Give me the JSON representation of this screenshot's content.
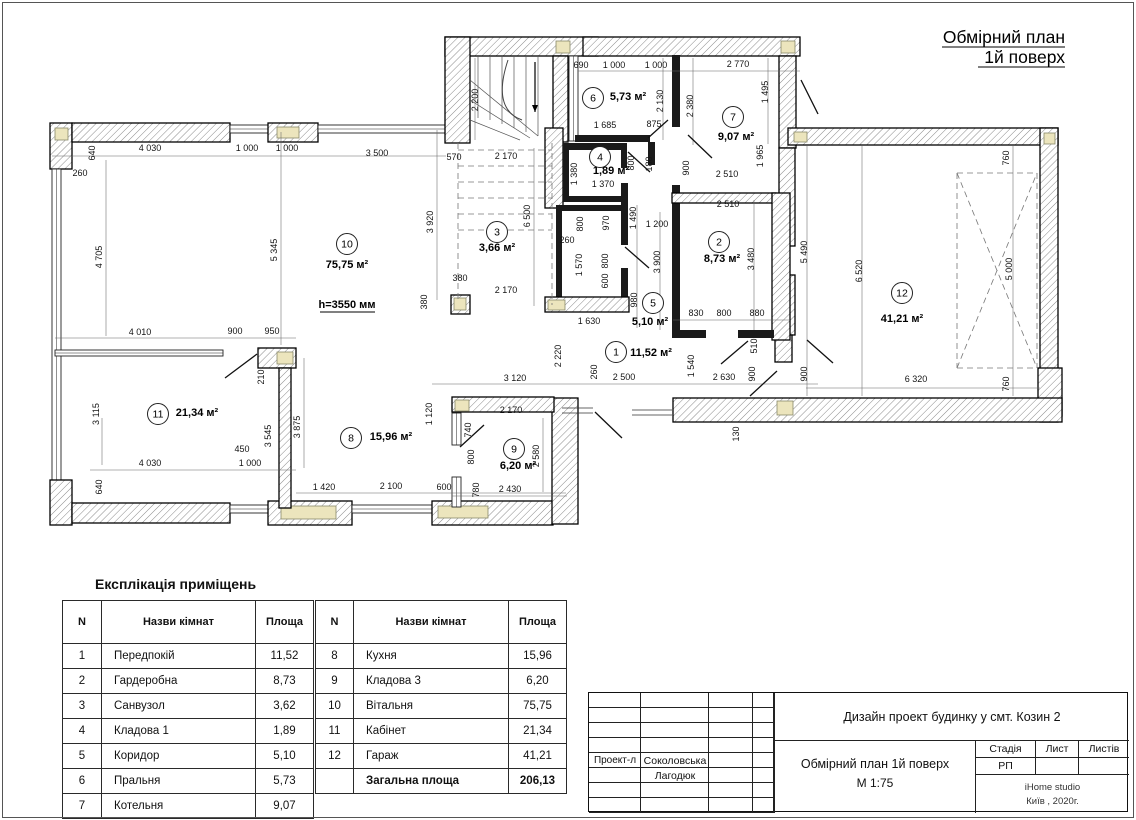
{
  "page_title": {
    "line1": "Обмірний план",
    "line2": "1й поверх"
  },
  "plan": {
    "height_note": "h=3550 мм",
    "rooms": [
      {
        "n": "1",
        "area": "11,52 м²",
        "cx": 616,
        "cy": 352,
        "ax": 651,
        "ay": 356
      },
      {
        "n": "2",
        "area": "8,73 м²",
        "cx": 719,
        "cy": 242,
        "ax": 722,
        "ay": 262
      },
      {
        "n": "3",
        "area": "3,66 м²",
        "cx": 497,
        "cy": 232,
        "ax": 497,
        "ay": 251
      },
      {
        "n": "4",
        "area": "1,89 м²",
        "cx": 600,
        "cy": 157,
        "ax": 611,
        "ay": 174
      },
      {
        "n": "5",
        "area": "5,10 м²",
        "cx": 653,
        "cy": 303,
        "ax": 650,
        "ay": 325
      },
      {
        "n": "6",
        "area": "5,73 м²",
        "cx": 593,
        "cy": 98,
        "ax": 628,
        "ay": 100
      },
      {
        "n": "7",
        "area": "9,07 м²",
        "cx": 733,
        "cy": 117,
        "ax": 736,
        "ay": 140
      },
      {
        "n": "8",
        "area": "15,96 м²",
        "cx": 351,
        "cy": 438,
        "ax": 391,
        "ay": 440
      },
      {
        "n": "9",
        "area": "6,20 м²",
        "cx": 514,
        "cy": 449,
        "ax": 518,
        "ay": 469
      },
      {
        "n": "10",
        "area": "75,75 м²",
        "cx": 347,
        "cy": 244,
        "ax": 347,
        "ay": 268
      },
      {
        "n": "11",
        "area": "21,34 м²",
        "cx": 158,
        "cy": 414,
        "ax": 197,
        "ay": 416
      },
      {
        "n": "12",
        "area": "41,21 м²",
        "cx": 902,
        "cy": 293,
        "ax": 902,
        "ay": 322
      }
    ],
    "dims": [
      [
        "640",
        95,
        153,
        1
      ],
      [
        "260",
        80,
        176,
        0
      ],
      [
        "4 030",
        150,
        151,
        0
      ],
      [
        "1 000",
        247,
        151,
        0
      ],
      [
        "1 000",
        287,
        151,
        0
      ],
      [
        "3 500",
        377,
        156,
        0
      ],
      [
        "570",
        454,
        160,
        0
      ],
      [
        "2 170",
        506,
        159,
        0
      ],
      [
        "2 200",
        478,
        100,
        1
      ],
      [
        "6 500",
        530,
        216,
        1
      ],
      [
        "3 920",
        433,
        222,
        1
      ],
      [
        "4 705",
        102,
        257,
        1
      ],
      [
        "5 345",
        277,
        250,
        1
      ],
      [
        "380",
        460,
        281,
        0
      ],
      [
        "380",
        427,
        302,
        1
      ],
      [
        "2 170",
        506,
        293,
        0
      ],
      [
        "4 010",
        140,
        335,
        0
      ],
      [
        "900",
        235,
        334,
        0
      ],
      [
        "950",
        272,
        334,
        0
      ],
      [
        "3 115",
        99,
        414,
        1
      ],
      [
        "210",
        264,
        377,
        1
      ],
      [
        "3 545",
        271,
        436,
        1
      ],
      [
        "3 875",
        300,
        427,
        1
      ],
      [
        "450",
        242,
        452,
        0
      ],
      [
        "1 000",
        250,
        466,
        0
      ],
      [
        "4 030",
        150,
        466,
        0
      ],
      [
        "640",
        102,
        487,
        1
      ],
      [
        "1 420",
        324,
        490,
        0
      ],
      [
        "2 100",
        391,
        489,
        0
      ],
      [
        "600",
        444,
        490,
        0
      ],
      [
        "1 120",
        432,
        414,
        1
      ],
      [
        "3 120",
        515,
        381,
        0
      ],
      [
        "2 170",
        511,
        413,
        0
      ],
      [
        "740",
        471,
        430,
        1
      ],
      [
        "800",
        474,
        457,
        1
      ],
      [
        "780",
        479,
        490,
        1
      ],
      [
        "2 430",
        510,
        492,
        0
      ],
      [
        "2 580",
        539,
        456,
        1
      ],
      [
        "690",
        581,
        68,
        0
      ],
      [
        "1 000",
        614,
        68,
        0
      ],
      [
        "1 000",
        656,
        68,
        0
      ],
      [
        "2 770",
        738,
        67,
        0
      ],
      [
        "1 495",
        768,
        92,
        1
      ],
      [
        "2 130",
        663,
        101,
        1
      ],
      [
        "2 380",
        693,
        106,
        1
      ],
      [
        "1 685",
        605,
        128,
        0
      ],
      [
        "875",
        654,
        127,
        0
      ],
      [
        "900",
        689,
        168,
        1
      ],
      [
        "180",
        652,
        164,
        1
      ],
      [
        "1 965",
        763,
        156,
        1
      ],
      [
        "2 510",
        727,
        177,
        0
      ],
      [
        "2 510",
        728,
        207,
        0
      ],
      [
        "1 380",
        577,
        174,
        1
      ],
      [
        "1 370",
        603,
        187,
        0
      ],
      [
        "800",
        634,
        163,
        1
      ],
      [
        "1 490",
        636,
        218,
        1
      ],
      [
        "1 200",
        657,
        227,
        0
      ],
      [
        "800",
        583,
        224,
        1
      ],
      [
        "970",
        609,
        223,
        1
      ],
      [
        "260",
        567,
        243,
        0
      ],
      [
        "1 570",
        582,
        265,
        1
      ],
      [
        "800",
        608,
        261,
        1
      ],
      [
        "600",
        608,
        281,
        1
      ],
      [
        "980",
        637,
        300,
        1
      ],
      [
        "3 900",
        660,
        262,
        1
      ],
      [
        "3 480",
        754,
        259,
        1
      ],
      [
        "5 490",
        807,
        252,
        1
      ],
      [
        "830",
        696,
        316,
        0
      ],
      [
        "800",
        724,
        316,
        0
      ],
      [
        "880",
        757,
        316,
        0
      ],
      [
        "1 630",
        589,
        324,
        0
      ],
      [
        "2 220",
        561,
        356,
        1
      ],
      [
        "260",
        597,
        372,
        1
      ],
      [
        "2 500",
        624,
        380,
        0
      ],
      [
        "1 540",
        694,
        366,
        1
      ],
      [
        "2 630",
        724,
        380,
        0
      ],
      [
        "900",
        755,
        374,
        1
      ],
      [
        "510",
        757,
        346,
        1
      ],
      [
        "900",
        807,
        374,
        1
      ],
      [
        "130",
        739,
        434,
        1
      ],
      [
        "760",
        1009,
        158,
        1
      ],
      [
        "6 520",
        862,
        271,
        1
      ],
      [
        "5 000",
        1012,
        269,
        1
      ],
      [
        "6 320",
        916,
        382,
        0
      ],
      [
        "760",
        1009,
        384,
        1
      ]
    ],
    "walls": [
      [
        50,
        123,
        22,
        46,
        "h"
      ],
      [
        55,
        128,
        13,
        12,
        "y"
      ],
      [
        72,
        123,
        158,
        19,
        "h"
      ],
      [
        230,
        125,
        38,
        8,
        "t"
      ],
      [
        268,
        123,
        50,
        19,
        "h"
      ],
      [
        277,
        127,
        22,
        11,
        "y"
      ],
      [
        318,
        125,
        128,
        8,
        "t"
      ],
      [
        52,
        169,
        9,
        311,
        "t"
      ],
      [
        50,
        480,
        22,
        45,
        "h"
      ],
      [
        72,
        503,
        158,
        20,
        "h"
      ],
      [
        230,
        505,
        40,
        8,
        "t"
      ],
      [
        268,
        501,
        84,
        24,
        "h"
      ],
      [
        281,
        506,
        55,
        13,
        "y"
      ],
      [
        352,
        505,
        80,
        8,
        "t"
      ],
      [
        432,
        501,
        121,
        24,
        "h"
      ],
      [
        438,
        506,
        50,
        12,
        "y"
      ],
      [
        552,
        398,
        26,
        126,
        "h"
      ],
      [
        452,
        397,
        102,
        15,
        "h"
      ],
      [
        455,
        400,
        14,
        11,
        "y"
      ],
      [
        452,
        413,
        9,
        32,
        "t"
      ],
      [
        452,
        477,
        9,
        30,
        "t"
      ],
      [
        258,
        348,
        38,
        20,
        "h"
      ],
      [
        277,
        352,
        16,
        12,
        "y"
      ],
      [
        55,
        350,
        168,
        6,
        "t"
      ],
      [
        279,
        368,
        12,
        140,
        "h"
      ],
      [
        445,
        37,
        153,
        19,
        "h"
      ],
      [
        455,
        41,
        14,
        12,
        "y"
      ],
      [
        556,
        41,
        14,
        12,
        "y"
      ],
      [
        445,
        37,
        25,
        106,
        "h"
      ],
      [
        553,
        56,
        15,
        86,
        "h"
      ],
      [
        545,
        128,
        18,
        80,
        "h"
      ],
      [
        451,
        295,
        19,
        19,
        "h"
      ],
      [
        454,
        298,
        12,
        12,
        "y"
      ],
      [
        583,
        37,
        217,
        19,
        "h"
      ],
      [
        781,
        41,
        14,
        12,
        "y"
      ],
      [
        569,
        56,
        9,
        85,
        "t"
      ],
      [
        779,
        56,
        17,
        92,
        "h"
      ],
      [
        575,
        135,
        75,
        7,
        "s"
      ],
      [
        648,
        142,
        7,
        23,
        "s"
      ],
      [
        672,
        55,
        8,
        72,
        "s"
      ],
      [
        788,
        128,
        270,
        17,
        "h"
      ],
      [
        794,
        132,
        13,
        10,
        "y"
      ],
      [
        1040,
        128,
        18,
        294,
        "h"
      ],
      [
        1044,
        133,
        11,
        11,
        "y"
      ],
      [
        1038,
        368,
        24,
        48,
        "h"
      ],
      [
        1043,
        399,
        13,
        13,
        "y"
      ],
      [
        673,
        398,
        389,
        24,
        "h"
      ],
      [
        777,
        401,
        16,
        14,
        "y"
      ],
      [
        779,
        148,
        16,
        98,
        "h"
      ],
      [
        779,
        275,
        16,
        60,
        "h"
      ],
      [
        775,
        335,
        17,
        27,
        "h"
      ],
      [
        563,
        143,
        64,
        7,
        "s"
      ],
      [
        563,
        150,
        6,
        50,
        "s"
      ],
      [
        563,
        196,
        64,
        6,
        "s"
      ],
      [
        556,
        205,
        6,
        100,
        "s"
      ],
      [
        560,
        205,
        64,
        6,
        "s"
      ],
      [
        621,
        150,
        6,
        18,
        "s"
      ],
      [
        621,
        183,
        7,
        62,
        "s"
      ],
      [
        621,
        268,
        7,
        40,
        "s"
      ],
      [
        545,
        297,
        84,
        15,
        "h"
      ],
      [
        548,
        300,
        17,
        10,
        "y"
      ],
      [
        672,
        185,
        8,
        150,
        "s"
      ],
      [
        672,
        193,
        104,
        10,
        "h"
      ],
      [
        772,
        193,
        18,
        147,
        "h"
      ],
      [
        672,
        330,
        34,
        8,
        "s"
      ],
      [
        738,
        330,
        36,
        8,
        "s"
      ]
    ],
    "doors": [
      [
        225,
        378,
        257,
        354
      ],
      [
        460,
        447,
        484,
        425
      ],
      [
        648,
        138,
        668,
        120
      ],
      [
        628,
        152,
        650,
        172
      ],
      [
        625,
        247,
        649,
        268
      ],
      [
        688,
        135,
        712,
        158
      ],
      [
        721,
        364,
        748,
        341
      ],
      [
        750,
        396,
        777,
        371
      ],
      [
        801,
        80,
        818,
        114
      ],
      [
        595,
        412,
        622,
        438
      ],
      [
        807,
        340,
        833,
        363
      ]
    ],
    "thin_lines": [
      [
        562,
        408,
        593,
        408
      ],
      [
        562,
        413,
        593,
        413
      ],
      [
        632,
        410,
        672,
        410
      ],
      [
        632,
        415,
        672,
        415
      ]
    ],
    "dim_lines": [
      [
        52,
        156,
        446,
        156
      ],
      [
        578,
        71,
        800,
        71
      ],
      [
        55,
        338,
        296,
        338
      ],
      [
        90,
        470,
        296,
        470
      ],
      [
        296,
        493,
        566,
        493
      ],
      [
        432,
        384,
        818,
        384
      ],
      [
        452,
        496,
        567,
        496
      ],
      [
        673,
        320,
        790,
        320
      ],
      [
        806,
        388,
        1040,
        388
      ],
      [
        106,
        160,
        106,
        336
      ],
      [
        281,
        132,
        281,
        345
      ],
      [
        437,
        130,
        437,
        300
      ],
      [
        534,
        148,
        534,
        306
      ],
      [
        862,
        146,
        862,
        396
      ],
      [
        807,
        146,
        807,
        396
      ],
      [
        1013,
        146,
        1013,
        396
      ],
      [
        543,
        418,
        543,
        492
      ],
      [
        304,
        358,
        304,
        468
      ],
      [
        768,
        58,
        768,
        144
      ],
      [
        663,
        58,
        663,
        140
      ],
      [
        693,
        58,
        693,
        145
      ],
      [
        660,
        212,
        660,
        330
      ],
      [
        637,
        205,
        637,
        328
      ],
      [
        754,
        200,
        754,
        330
      ],
      [
        475,
        58,
        475,
        140
      ],
      [
        102,
        418,
        102,
        465
      ]
    ],
    "dashed_lines": [
      [
        458,
        143,
        458,
        300
      ],
      [
        552,
        143,
        552,
        305
      ],
      [
        458,
        150,
        552,
        150
      ],
      [
        458,
        166,
        552,
        166
      ],
      [
        458,
        182,
        552,
        182
      ],
      [
        458,
        198,
        552,
        198
      ],
      [
        458,
        214,
        552,
        214
      ],
      [
        458,
        230,
        552,
        230
      ],
      [
        957,
        173,
        1037,
        173
      ],
      [
        1037,
        173,
        1037,
        368
      ],
      [
        957,
        368,
        1037,
        368
      ],
      [
        957,
        173,
        957,
        368
      ],
      [
        957,
        173,
        1037,
        368
      ],
      [
        957,
        368,
        1037,
        173
      ]
    ],
    "stair_lines": [
      [
        478,
        56,
        478,
        118
      ],
      [
        490,
        56,
        490,
        120
      ],
      [
        502,
        56,
        502,
        124
      ],
      [
        514,
        56,
        514,
        128
      ],
      [
        526,
        56,
        526,
        132
      ],
      [
        538,
        56,
        538,
        136
      ],
      [
        470,
        80,
        538,
        136
      ],
      [
        470,
        100,
        530,
        138
      ],
      [
        470,
        120,
        520,
        140
      ]
    ],
    "stair_arrow": {
      "x": 535,
      "y1": 62,
      "y2": 112
    },
    "underlines": [
      [
        320,
        312,
        375,
        312
      ],
      [
        942,
        47,
        1065,
        47
      ],
      [
        978,
        67,
        1065,
        67
      ]
    ],
    "height_note_pos": {
      "x": 347,
      "y": 308
    }
  },
  "legend": {
    "title": "Експлікація приміщень",
    "headers": [
      "N",
      "Назви кімнат",
      "Площа"
    ],
    "left_rows": [
      [
        "1",
        "Передпокій",
        "11,52"
      ],
      [
        "2",
        "Гардеробна",
        "8,73"
      ],
      [
        "3",
        "Санвузол",
        "3,62"
      ],
      [
        "4",
        "Кладова 1",
        "1,89"
      ],
      [
        "5",
        "Коридор",
        "5,10"
      ],
      [
        "6",
        "Пральня",
        "5,73"
      ],
      [
        "7",
        "Котельня",
        "9,07"
      ]
    ],
    "right_rows": [
      [
        "8",
        "Кухня",
        "15,96"
      ],
      [
        "9",
        "Кладова 3",
        "6,20"
      ],
      [
        "10",
        "Вітальня",
        "75,75"
      ],
      [
        "11",
        "Кабінет",
        "21,34"
      ],
      [
        "12",
        "Гараж",
        "41,21"
      ],
      [
        "",
        "Загальна площа",
        "206,13"
      ]
    ]
  },
  "titleblock": {
    "project": "Дизайн проект будинку у смт. Козин 2",
    "doc_title": "Обмірний план 1й поверх",
    "doc_scale": "М 1:75",
    "role_label": "Проект-л",
    "name1": "Соколовська",
    "name2": "Лагодюк",
    "stage_label": "Стадія",
    "sheet_label": "Лист",
    "sheets_label": "Листів",
    "stage_value": "РП",
    "studio": "iHome studio",
    "city_year": "Київ ,  2020г."
  }
}
